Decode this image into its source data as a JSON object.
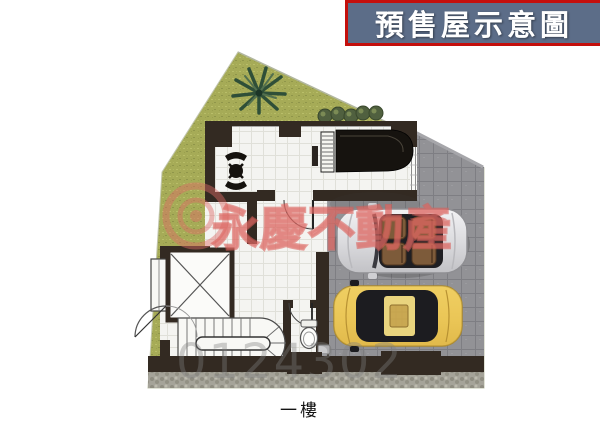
{
  "header": {
    "title": "預售屋示意圖",
    "bg_color": "#5c6d88",
    "border_color": "#c40f0c",
    "text_color": "#ffffff"
  },
  "plan": {
    "floor_label": "一樓",
    "watermark_brand": "永慶不動產",
    "watermark_serial": "0124302"
  },
  "colors": {
    "grass": "#a6ab57",
    "pavement": "#929296",
    "wall": "#332a22",
    "floor": "#f4f4f1",
    "watermark_pink": "#dd6b66",
    "car_silver": "#e9e9eb",
    "car_yellow": "#ecc75a",
    "seat_brown": "#7d5b3a"
  },
  "icons": {
    "palm-tree-icon": "tropical plant on lawn",
    "bush-icon": "row of five round shrubs",
    "grand-piano-icon": "grand piano top view",
    "table-icon": "small table with two chairs",
    "elevator-icon": "elevator shaft with X",
    "staircase-icon": "U-shaped staircase",
    "toilet-icon": "toilet top view",
    "sink-icon": "pedestal sink",
    "silver-convertible-icon": "silver convertible with brown seats, top view",
    "yellow-car-icon": "yellow car, top view",
    "door-arc-icon": "door swing arc"
  }
}
